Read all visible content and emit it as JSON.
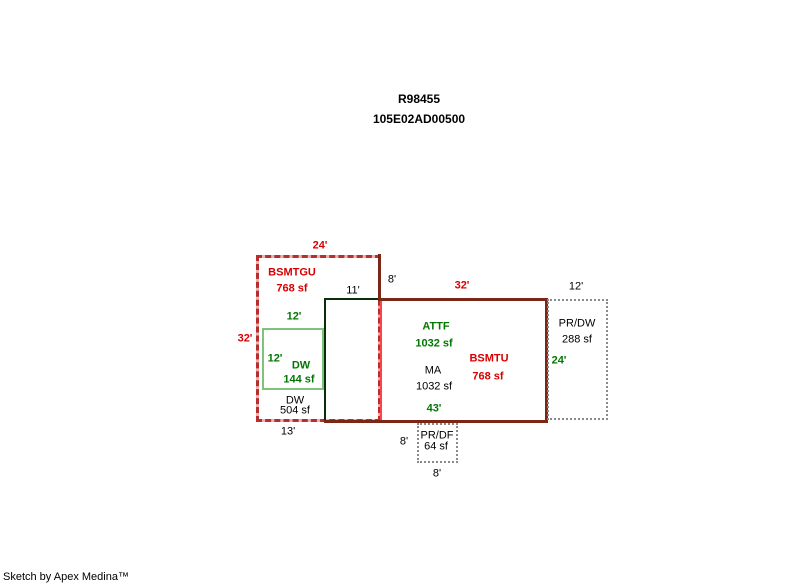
{
  "header": {
    "record_id": "R98455",
    "parcel_number": "105E02AD00500"
  },
  "footer": {
    "attribution": "Sketch by Apex Medina™"
  },
  "colors": {
    "red_text": "#d80000",
    "green_text": "#007700",
    "black_text": "#000000",
    "bsmtgu_dash_red": "#b52f2f",
    "bsmtgu_dash_pink": "#efb0b0",
    "dw_outline_green": "#7cc47c",
    "main_area_outline": "#0a2e0a",
    "bsmtu_outline_maroon": "#7c2615",
    "bsmtu_left_edge_red": "#ff4343",
    "porch_outline_gray": "#8a8a8a"
  },
  "sketch": {
    "bsmtgu": {
      "dim_top": "24'",
      "label": "BSMTGU",
      "area": "768 sf",
      "dim_left": "32'"
    },
    "jog": {
      "dim_vertical": "8'",
      "dim_horizontal": "11'"
    },
    "dw_garage": {
      "dim_top": "12'",
      "dim_left": "12'",
      "label": "DW",
      "area": "144 sf"
    },
    "dw_lower": {
      "label": "DW",
      "area": "504 sf",
      "dim_bottom": "13'"
    },
    "attf": {
      "label": "ATTF",
      "area": "1032 sf"
    },
    "ma": {
      "label": "MA",
      "area": "1032 sf",
      "dim_bottom": "43'"
    },
    "bsmtu": {
      "dim_top": "32'",
      "label": "BSMTU",
      "area": "768 sf",
      "dim_right": "24'"
    },
    "pr_dw": {
      "dim_top": "12'",
      "label": "PR/DW",
      "area": "288 sf"
    },
    "pr_df": {
      "dim_left": "8'",
      "label": "PR/DF",
      "area": "64 sf",
      "dim_bottom": "8'"
    }
  }
}
